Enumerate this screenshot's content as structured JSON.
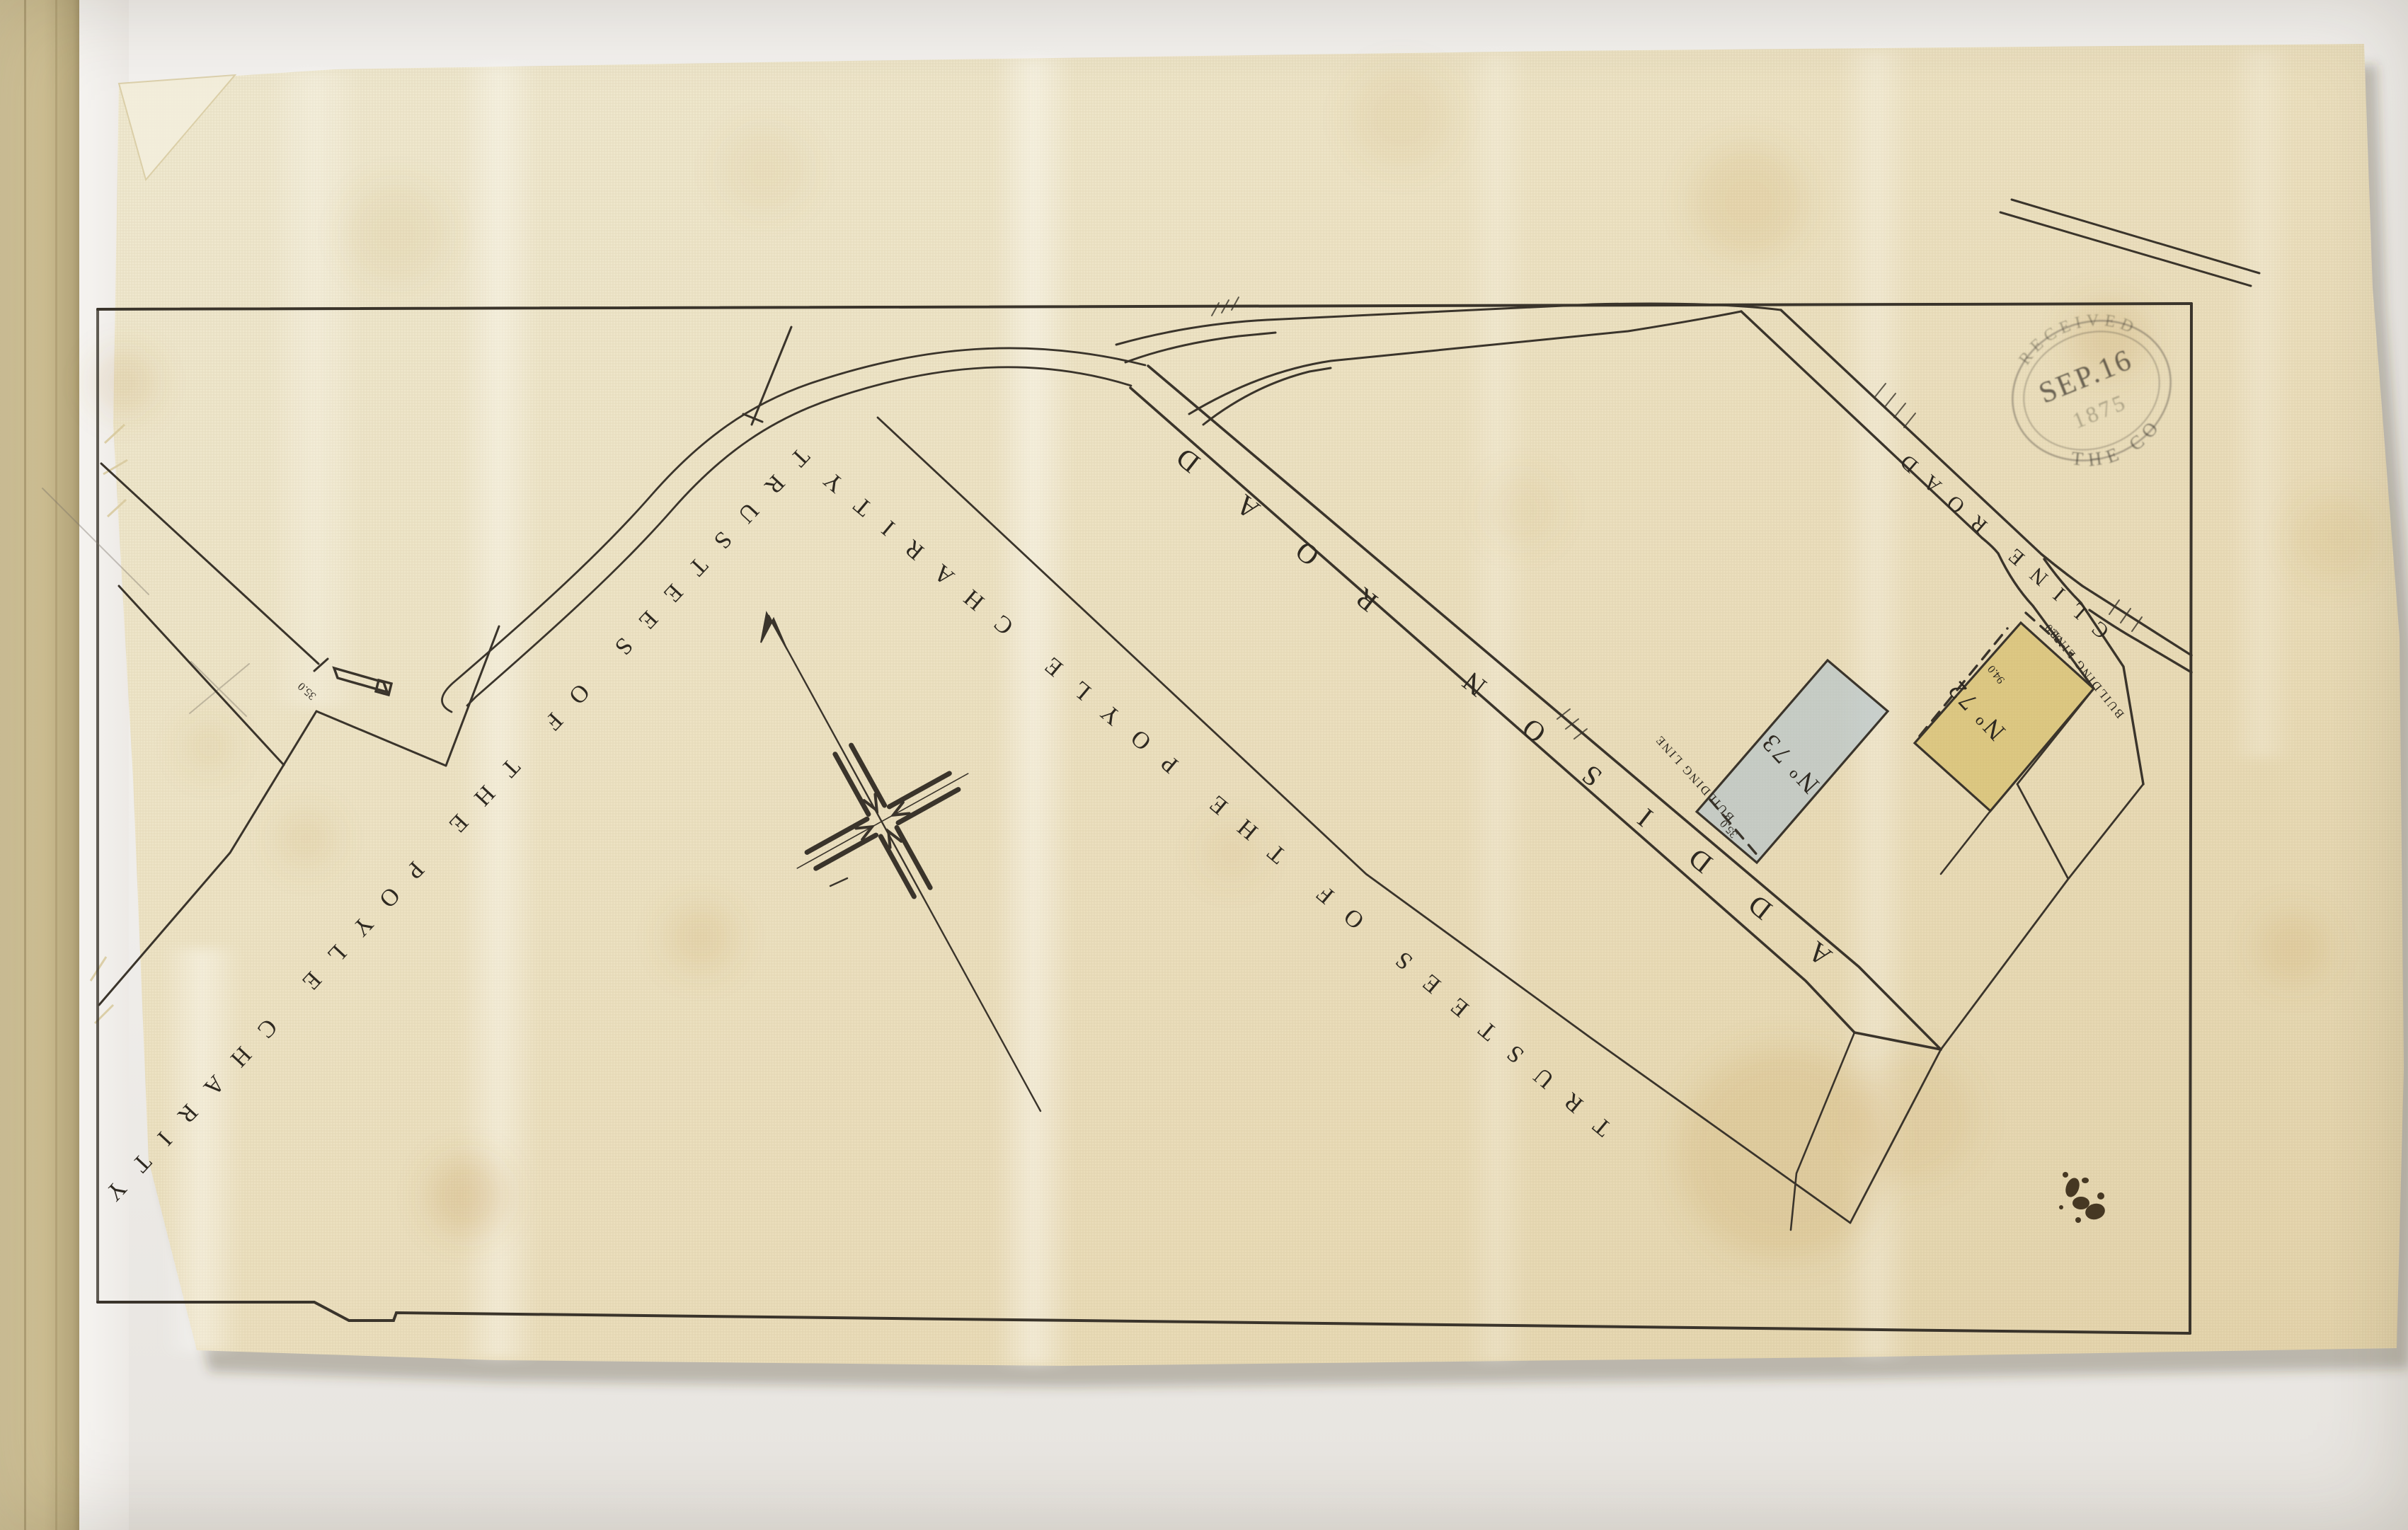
{
  "map": {
    "charity_label_upper": "TRUSTEES OF THE POYLE CHARITY",
    "charity_label_lower": "TRUSTEES OF THE POYLE CHARITY",
    "roads": {
      "addison": "ADDISON ROAD",
      "cline": "CLINE ROAD"
    },
    "plots": [
      {
        "id": "72",
        "label": "Nº 72",
        "color": "#cfb44e"
      },
      {
        "id": "73",
        "label": "Nº 73",
        "color": "#afc2cd"
      }
    ],
    "annotations": {
      "building_line_73": "BUILDING LINE",
      "building_line_72": "BUILDING LINE",
      "setback_73": "35.0",
      "frontage_72": "30.0",
      "depth_72": "94.0",
      "boundary_gap": "35.0"
    },
    "ink_color": "#3a342b"
  },
  "stamp": {
    "arc_top": "RECEIVED",
    "date": "SEP.16",
    "year": "1875",
    "arc_bottom": "THE CO",
    "color": "#46413a"
  }
}
